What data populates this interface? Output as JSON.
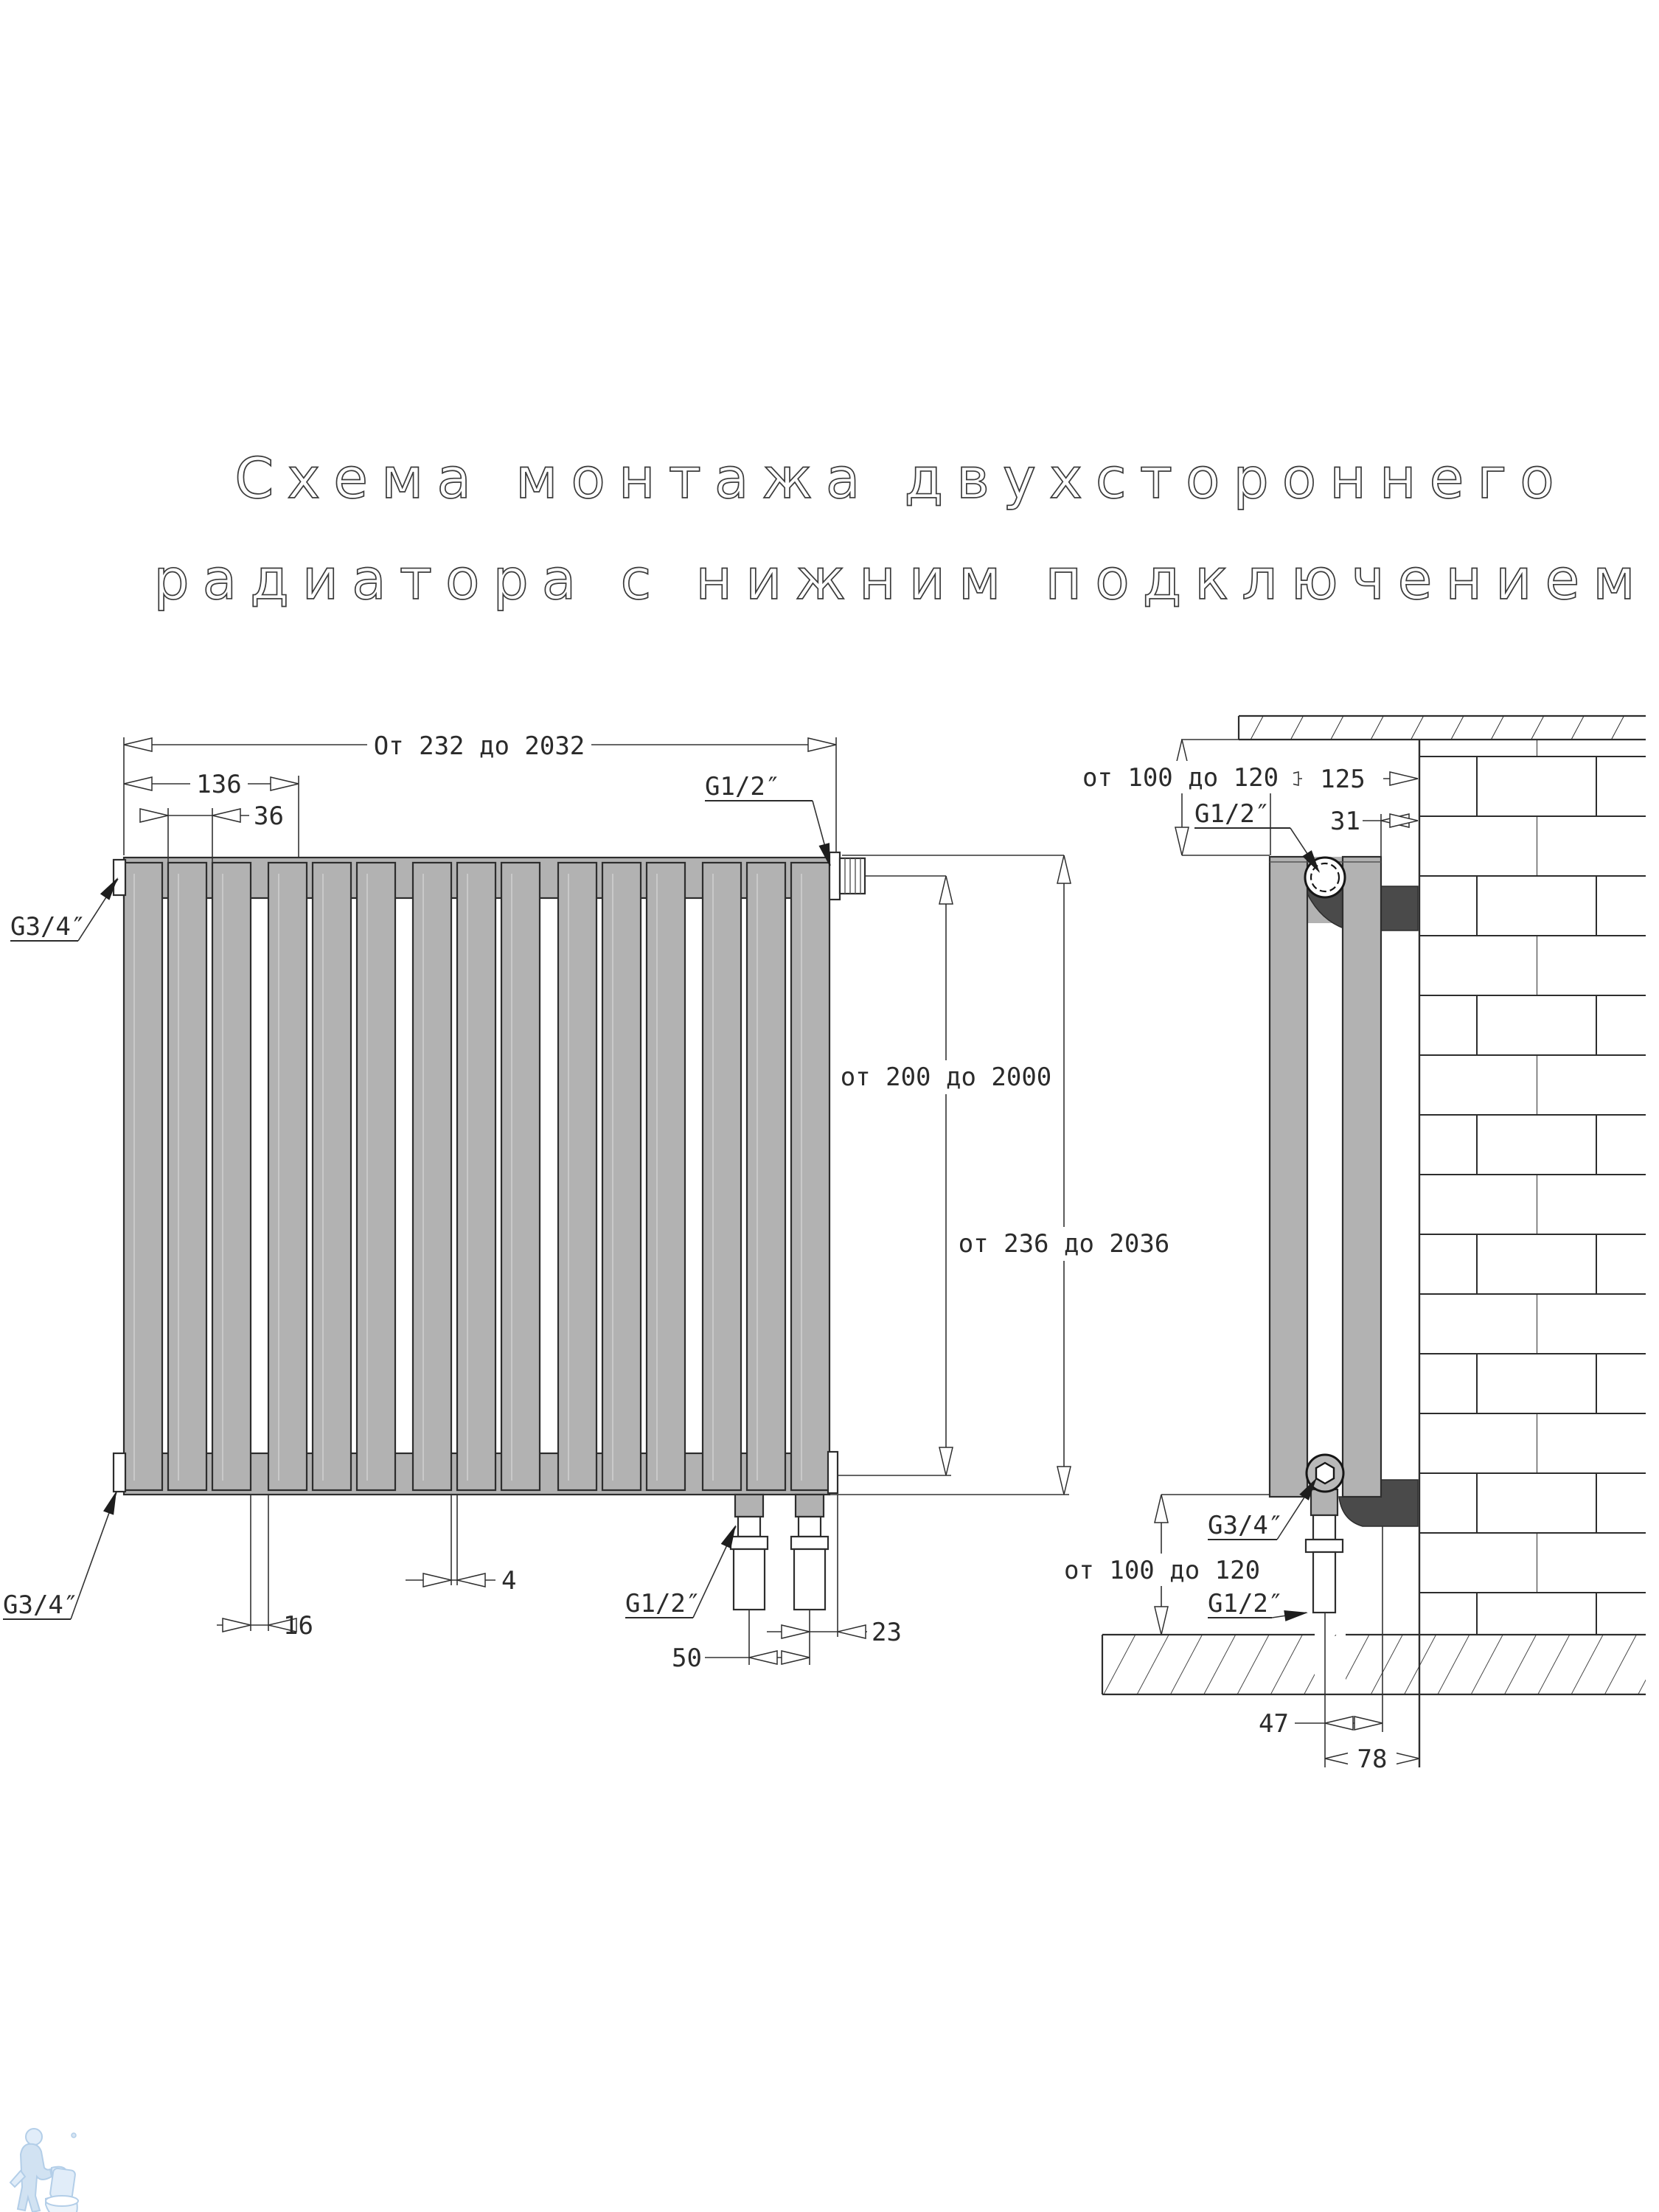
{
  "title": {
    "line1": "Схема монтажа двухстороннего",
    "line2": "радиатора с нижним подключением"
  },
  "front_view": {
    "width_range": "От 232 до 2032",
    "dim_group_width": "136",
    "dim_slat_pitch": "36",
    "thread_top_right": "G1/2″",
    "thread_top_left": "G3/4″",
    "thread_bottom_left": "G3/4″",
    "thread_bottom_pipes": "G1/2″",
    "slat_height_range": "от 200 до 2000",
    "total_height_range": "от 236 до 2036",
    "dim_group_gap": "16",
    "dim_slat_gap": "4",
    "dim_pipe_spacing": "50",
    "dim_pipe_to_edge": "23"
  },
  "side_view": {
    "top_clearance": "от 100 до 120",
    "dim_depth": "125",
    "dim_wall_gap": "31",
    "thread_top": "G1/2″",
    "thread_bottom_union": "G3/4″",
    "bottom_clearance": "от 100 до 120",
    "thread_bottom_pipe": "G1/2″",
    "dim_pipe_to_bracket": "47",
    "dim_pipe_to_wall": "78"
  },
  "colors": {
    "radiator_gray": "#b2b2b2",
    "bracket_dark": "#4a4a4a",
    "line_dark": "#2d2d2d",
    "watermark_blue": "#cfe0f2"
  }
}
